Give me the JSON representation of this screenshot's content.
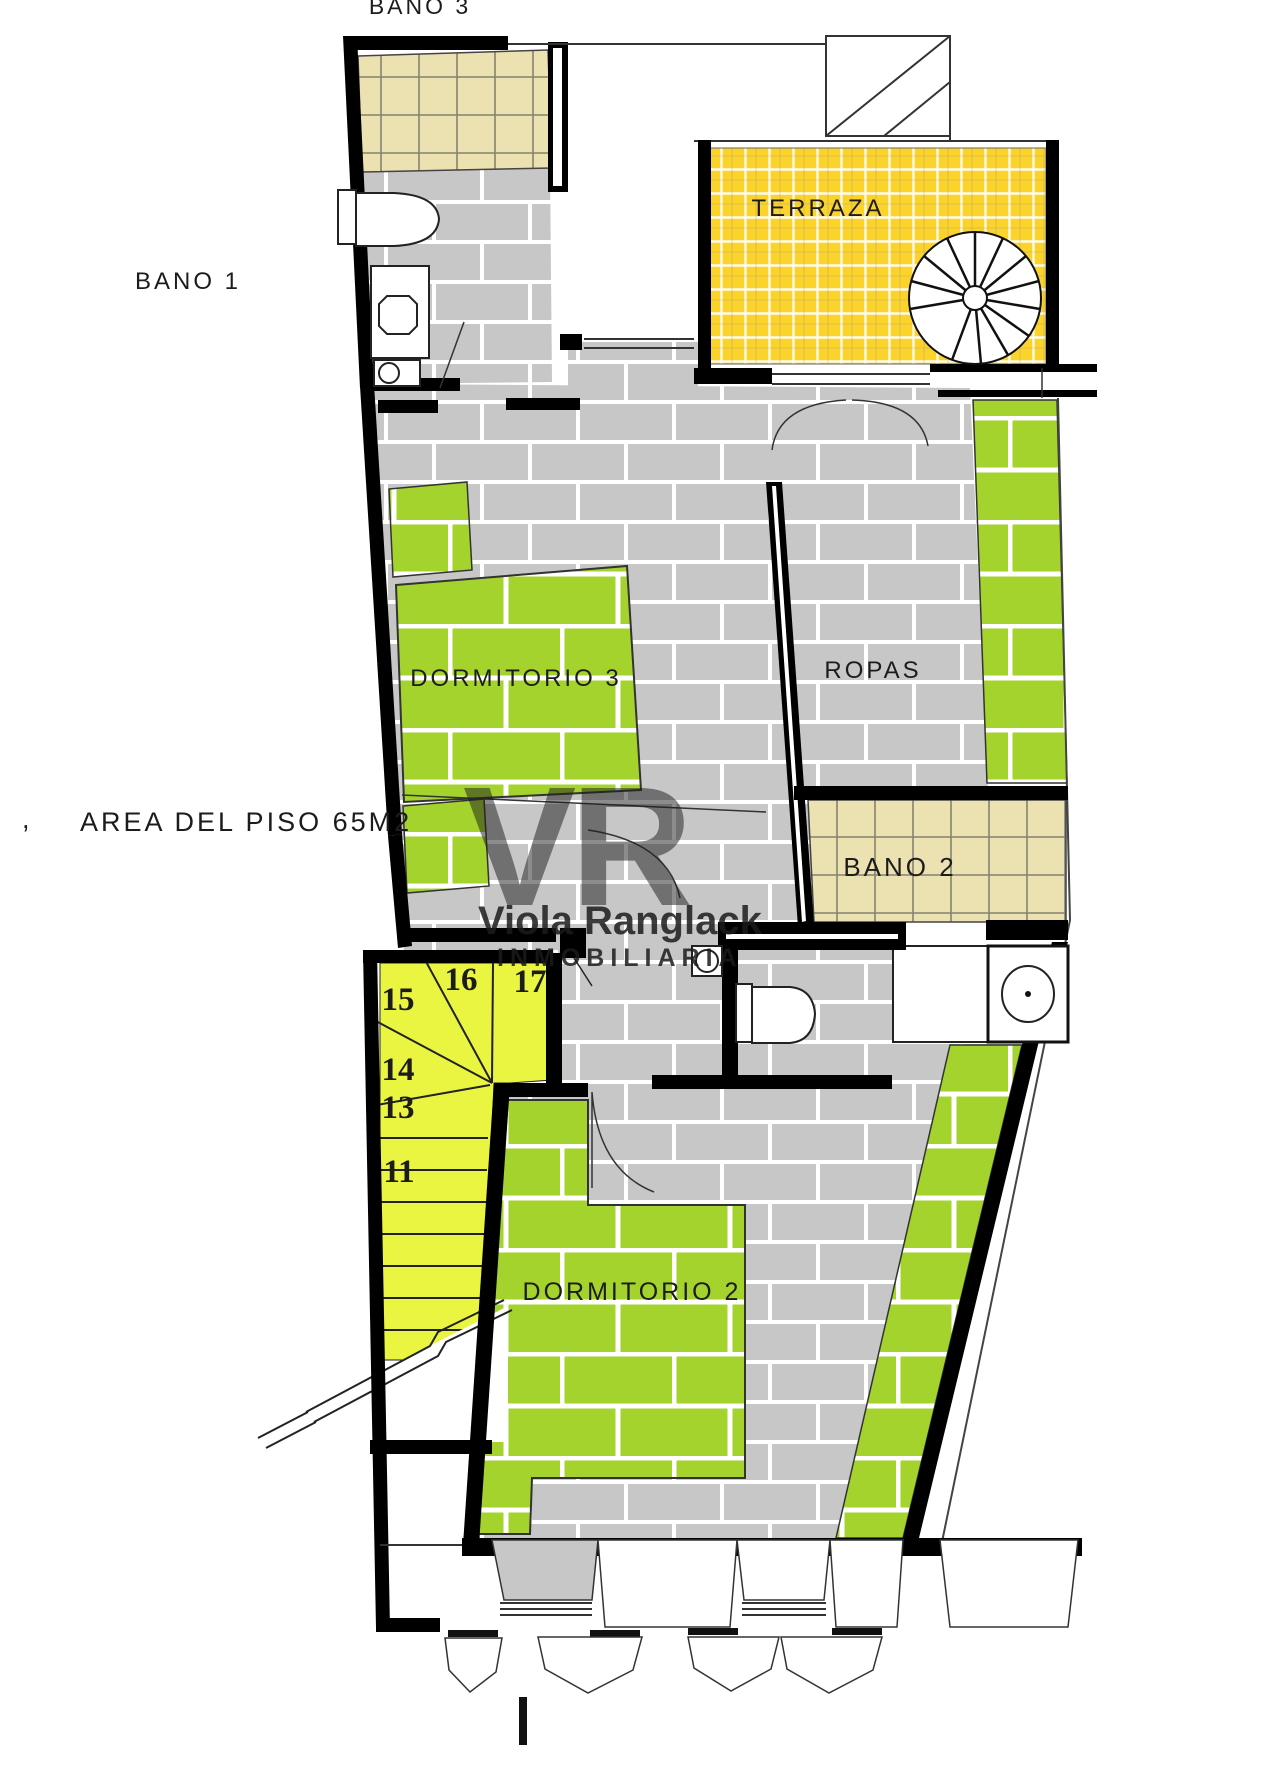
{
  "labels": {
    "bano3": "BANO 3",
    "bano1": "BANO 1",
    "terraza": "TERRAZA",
    "dormitorio3": "DORMITORIO 3",
    "ropas": "ROPAS",
    "bano2": "BANO 2",
    "dormitorio2": "DORMITORIO 2",
    "area_comma": ",",
    "area": "AREA DEL PISO 65M2"
  },
  "stairs": {
    "numbers": [
      "11",
      "13",
      "14",
      "15",
      "16",
      "17"
    ]
  },
  "watermark": {
    "initials": "VR",
    "name": "Viola Ranglack",
    "subtitle": "INMOBILIARIA"
  },
  "colors": {
    "floor_gray": "#c7c7c7",
    "brick_green": "#a5d32d",
    "tile_beige": "#ece1b0",
    "tile_yellow": "#fbd32b",
    "stair_yellow": "#eaf542",
    "wall_black": "#000000",
    "grout_white": "#ffffff",
    "watermark_gray": "#cccccc"
  }
}
